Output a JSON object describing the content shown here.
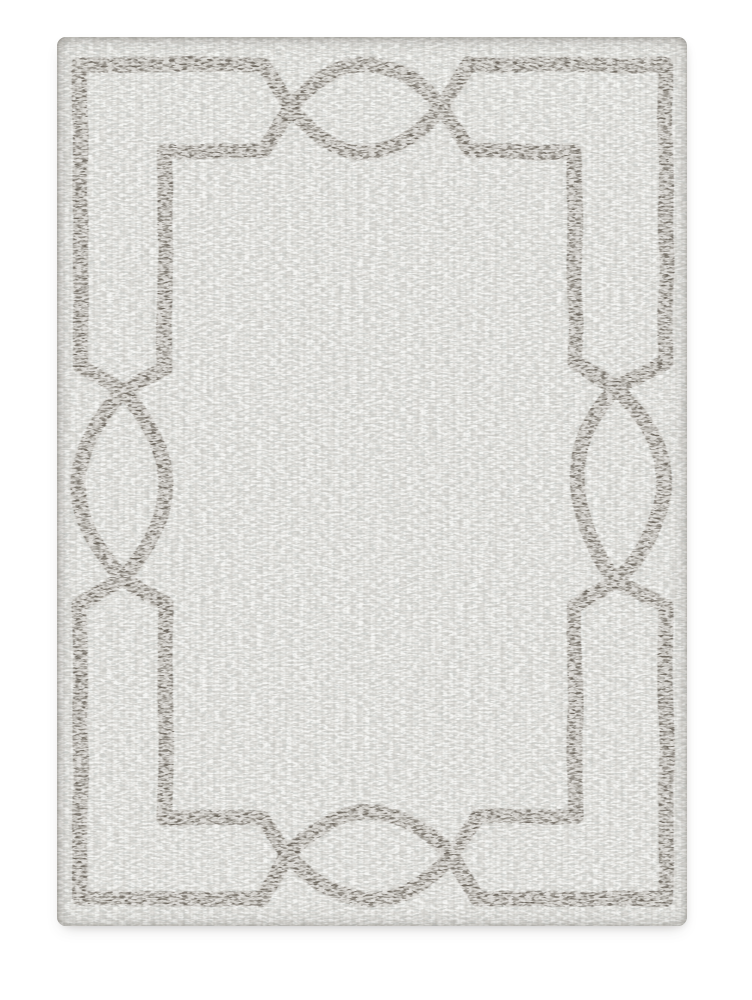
{
  "page": {
    "background_color": "#ffffff",
    "alt_text": "Product photograph of a rectangular area rug centered on a plain white background"
  },
  "rug": {
    "subject": "rectangular hooked area rug, overhead view",
    "texture_description": "heathered ivory-gray boucle weave with fine horizontal flecks",
    "pattern_description": "taupe fretwork frame: an outer border line and a stepped inner border line that converge and interlace into a pointed-oval ellipse motif at the midpoint of each side",
    "field_color": "#d3d5d2",
    "pattern_color": "#6e675f",
    "speckle_light_color": "#ffffff",
    "speckle_dark_color": "#948e84",
    "stroke_width": 15,
    "paths": {
      "outer_loop": "M 23 28 H 206 L 233 71 Q 309 159 385 71 L 412 28 H 609 V 325 L 559 351 Q 481 447 559 543 L 609 569 V 862 H 421 L 395 818 Q 313 732 231 818 L 205 862 H 23 V 568 L 64 542 Q 154 449 64 356 L 23 330 Z",
      "inner_loop": "M 108 114 H 206 L 233 71 Q 309 -17 385 71 L 412 114 H 518 V 325 L 559 351 Q 655 447 559 543 L 518 569 V 780 H 421 L 395 818 Q 313 908 231 818 L 206 780 H 108 V 568 L 64 542 Q -22 449 64 356 L 108 330 Z"
    }
  }
}
